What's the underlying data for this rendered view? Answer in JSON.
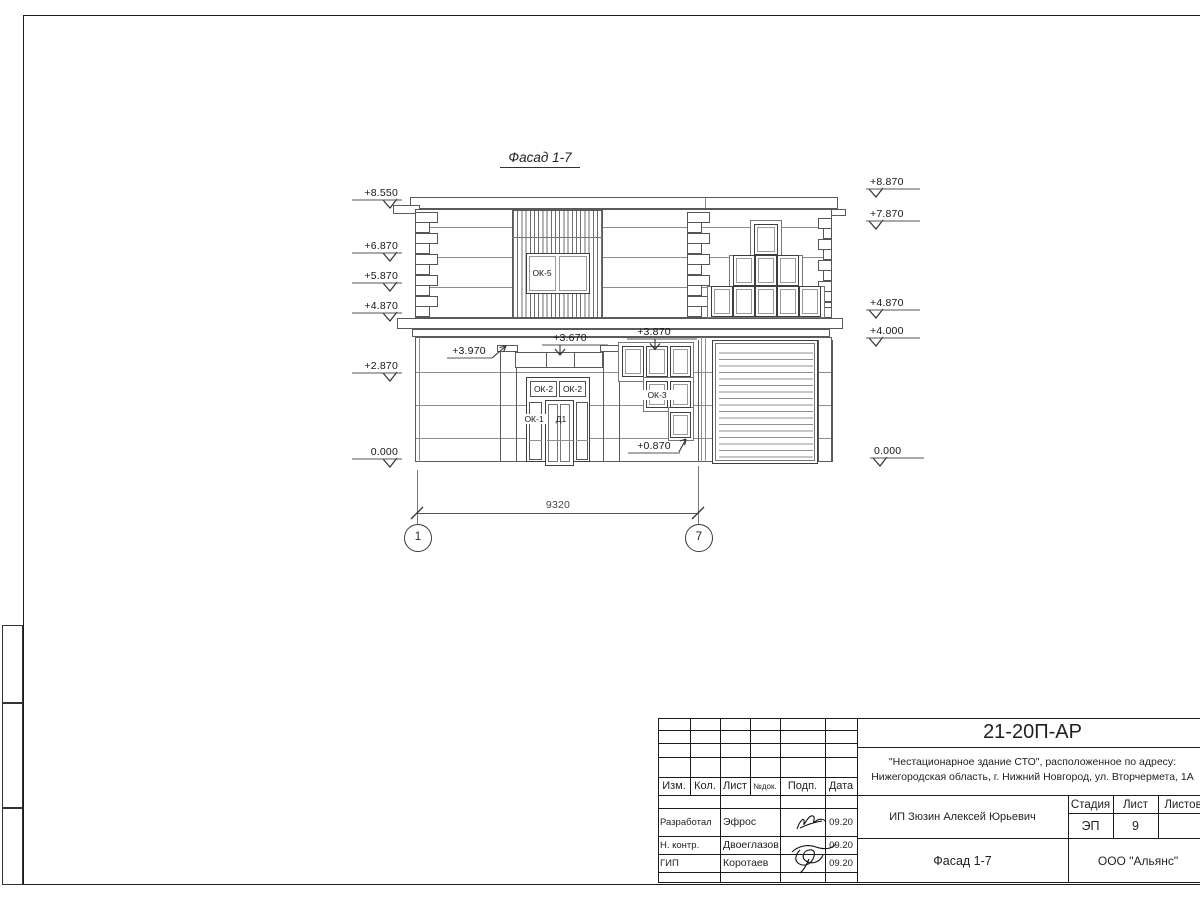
{
  "sheet": {
    "title": "Фасад 1-7",
    "marks_left": [
      "+8.550",
      "+6.870",
      "+5.870",
      "+4.870",
      "+2.870",
      "0.000"
    ],
    "marks_right": [
      "+8.870",
      "+7.870",
      "+4.870",
      "+4.000",
      "0.000"
    ],
    "marks_inner": {
      "pilaster_top": "+3.970",
      "canopy": "+3.670",
      "window_top": "+3.870",
      "window_sill": "+0.870"
    },
    "window_labels": {
      "ok5": "ОК-5",
      "ok2_left": "ОК-2",
      "ok2_right": "ОК-2",
      "ok1": "ОК-1",
      "door": "Д1",
      "ok3": "ОК-3"
    },
    "dimension": {
      "value": "9320",
      "axis_start": "1",
      "axis_end": "7"
    }
  },
  "titleblock": {
    "doc_number": "21-20П-АР",
    "project_line1": "\"Нестационарное здание СТО\", расположенное по адресу:",
    "project_line2": "Нижегородская область, г. Нижний Новгород, ул. Вторчермета, 1А",
    "client": "ИП Зюзин Алексей Юрьевич",
    "drawing_name": "Фасад 1-7",
    "company": "ООО \"Альянс\"",
    "header": {
      "izm": "Изм.",
      "kol": "Кол.",
      "list": "Лист",
      "ndok": "№док.",
      "podp": "Подп.",
      "data": "Дата"
    },
    "stage": {
      "label": "Стадия",
      "value": "ЭП"
    },
    "sheet_no": {
      "label": "Лист",
      "value": "9"
    },
    "sheets_total": {
      "label": "Листов",
      "value": ""
    },
    "signers": [
      {
        "role": "Разработал",
        "name": "Эфрос",
        "date": "09.20"
      },
      {
        "role": "Н. контр.",
        "name": "Двоеглазов",
        "date": "09.20"
      },
      {
        "role": "ГИП",
        "name": "Коротаев",
        "date": "09.20"
      }
    ]
  }
}
